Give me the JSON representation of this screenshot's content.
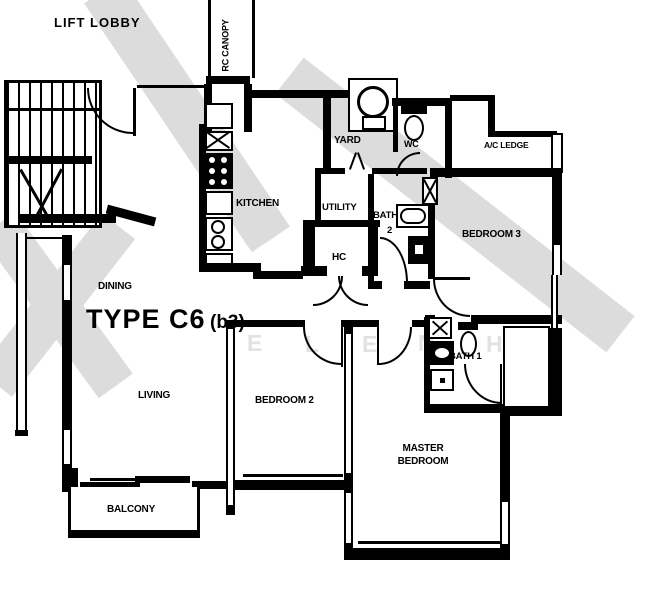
{
  "plan": {
    "type_main": "TYPE C6",
    "type_sub": "(b3)"
  },
  "rooms": {
    "lift_lobby": "LIFT LOBBY",
    "rc_canopy": "RC CANOPY",
    "yard": "YARD",
    "wc": "WC",
    "ac_ledge": "A/C LEDGE",
    "kitchen": "KITCHEN",
    "utility": "UTILITY",
    "bath2_line1": "BATH",
    "bath2_line2": "2",
    "hc": "HC",
    "bedroom3": "BEDROOM 3",
    "dining": "DINING",
    "living": "LIVING",
    "bedroom2": "BEDROOM 2",
    "bath1": "BATH 1",
    "master_line1": "MASTER",
    "master_line2": "BEDROOM",
    "balcony": "BALCONY"
  },
  "watermark": {
    "letters": [
      "E",
      "L",
      "E",
      "N",
      "H"
    ]
  },
  "colors": {
    "ink": "#000000",
    "watermark_stroke": "#dcdcdc",
    "watermark_text": "#e2e2e2",
    "background": "#ffffff"
  }
}
